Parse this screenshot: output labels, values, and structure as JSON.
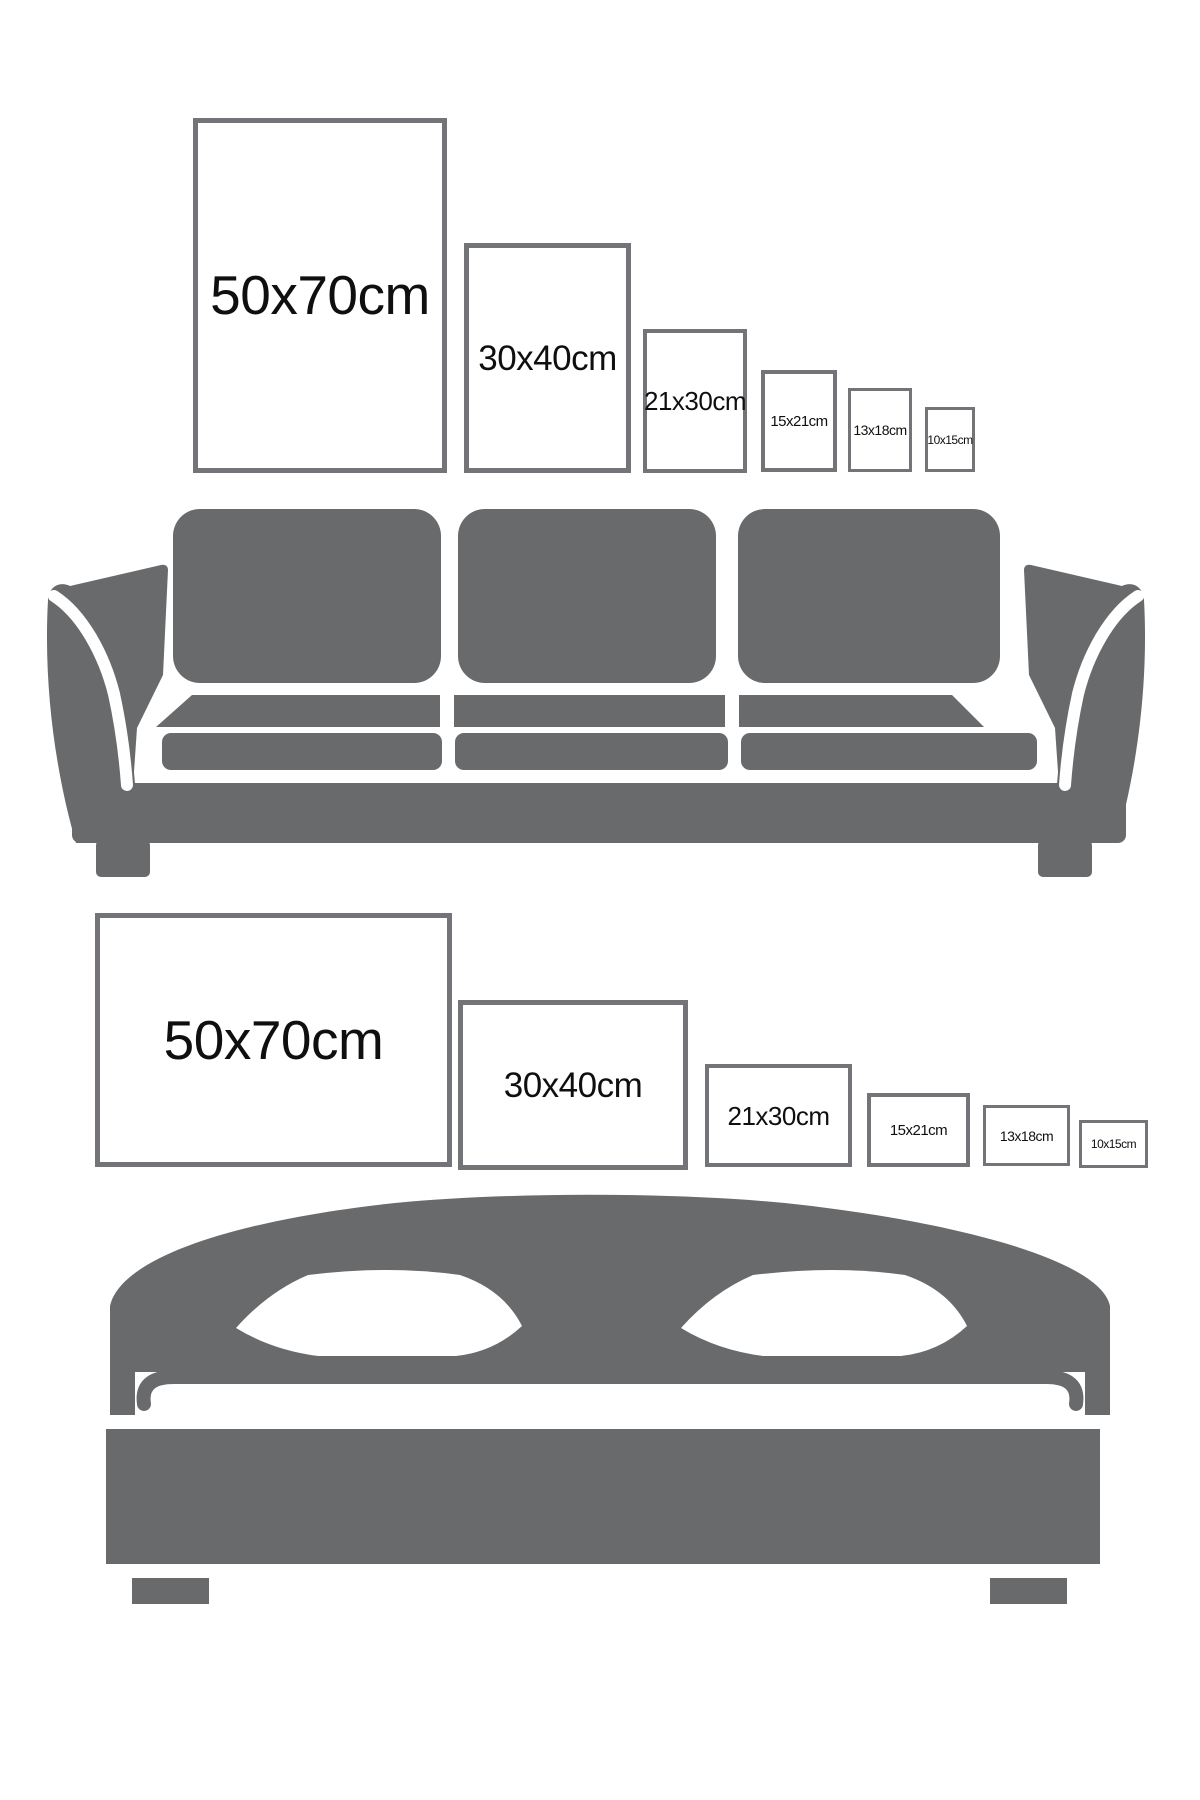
{
  "page": {
    "background_color": "#ffffff",
    "furniture_color": "#696a6c",
    "frame_border_color": "#737477",
    "label_color": "#0f0f0f"
  },
  "sections": [
    {
      "id": "wall-above-sofa",
      "orientation": "portrait",
      "furniture": "sofa",
      "furniture_icon": "sofa-icon",
      "frames": [
        {
          "label": "50x70cm",
          "size_cm": "50x70",
          "x": 193,
          "y": 118,
          "w": 254,
          "h": 355,
          "font": 55,
          "border": 5
        },
        {
          "label": "30x40cm",
          "size_cm": "30x40",
          "x": 464,
          "y": 243,
          "w": 167,
          "h": 230,
          "font": 35,
          "border": 5
        },
        {
          "label": "21x30cm",
          "size_cm": "21x30",
          "x": 643,
          "y": 329,
          "w": 104,
          "h": 144,
          "font": 26,
          "border": 4
        },
        {
          "label": "15x21cm",
          "size_cm": "15x21",
          "x": 761,
          "y": 370,
          "w": 76,
          "h": 102,
          "font": 15,
          "border": 4
        },
        {
          "label": "13x18cm",
          "size_cm": "13x18",
          "x": 848,
          "y": 388,
          "w": 64,
          "h": 84,
          "font": 14,
          "border": 3
        },
        {
          "label": "10x15cm",
          "size_cm": "10x15",
          "x": 925,
          "y": 407,
          "w": 50,
          "h": 65,
          "font": 12,
          "border": 3
        }
      ]
    },
    {
      "id": "wall-above-bed",
      "orientation": "landscape",
      "furniture": "bed",
      "furniture_icon": "bed-icon",
      "frames": [
        {
          "label": "50x70cm",
          "size_cm": "50x70",
          "x": 95,
          "y": 913,
          "w": 357,
          "h": 254,
          "font": 55,
          "border": 5
        },
        {
          "label": "30x40cm",
          "size_cm": "30x40",
          "x": 458,
          "y": 1000,
          "w": 230,
          "h": 170,
          "font": 35,
          "border": 5
        },
        {
          "label": "21x30cm",
          "size_cm": "21x30",
          "x": 705,
          "y": 1064,
          "w": 147,
          "h": 103,
          "font": 26,
          "border": 4
        },
        {
          "label": "15x21cm",
          "size_cm": "15x21",
          "x": 867,
          "y": 1093,
          "w": 103,
          "h": 74,
          "font": 15,
          "border": 4
        },
        {
          "label": "13x18cm",
          "size_cm": "13x18",
          "x": 983,
          "y": 1105,
          "w": 87,
          "h": 61,
          "font": 14,
          "border": 3
        },
        {
          "label": "10x15cm",
          "size_cm": "10x15",
          "x": 1079,
          "y": 1120,
          "w": 69,
          "h": 48,
          "font": 12,
          "border": 3
        }
      ]
    }
  ]
}
